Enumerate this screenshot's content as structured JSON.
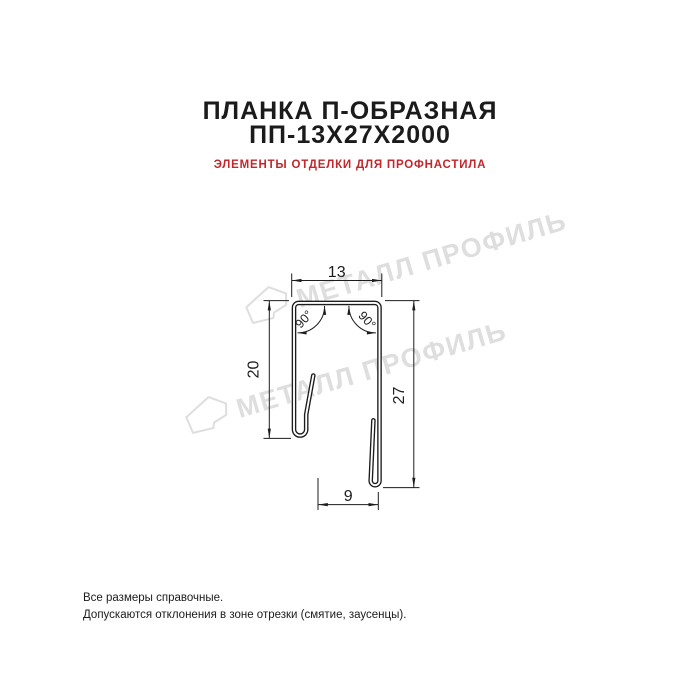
{
  "header": {
    "title_line1": "ПЛАНКА П-ОБРАЗНАЯ",
    "title_line2": "ПП-13Х27Х2000",
    "subtitle": "ЭЛЕМЕНТЫ ОТДЕЛКИ ДЛЯ ПРОФНАСТИЛА",
    "title_color": "#1b1b1b",
    "subtitle_color": "#c1272d"
  },
  "drawing": {
    "type": "technical-cross-section",
    "line_color": "#1c1c1c",
    "dimensions": {
      "top_width": "13",
      "left_height": "20",
      "right_height": "27",
      "bottom_width": "9",
      "angle_left": "90°",
      "angle_right": "90°"
    }
  },
  "watermark": {
    "text": "МЕТАЛЛ ПРОФИЛЬ",
    "color": "#dedede",
    "logo": "metall-profil-logo"
  },
  "footer": {
    "line1": "Все размеры справочные.",
    "line2": "Допускаются отклонения в зоне отрезки (смятие, заусенцы)."
  }
}
